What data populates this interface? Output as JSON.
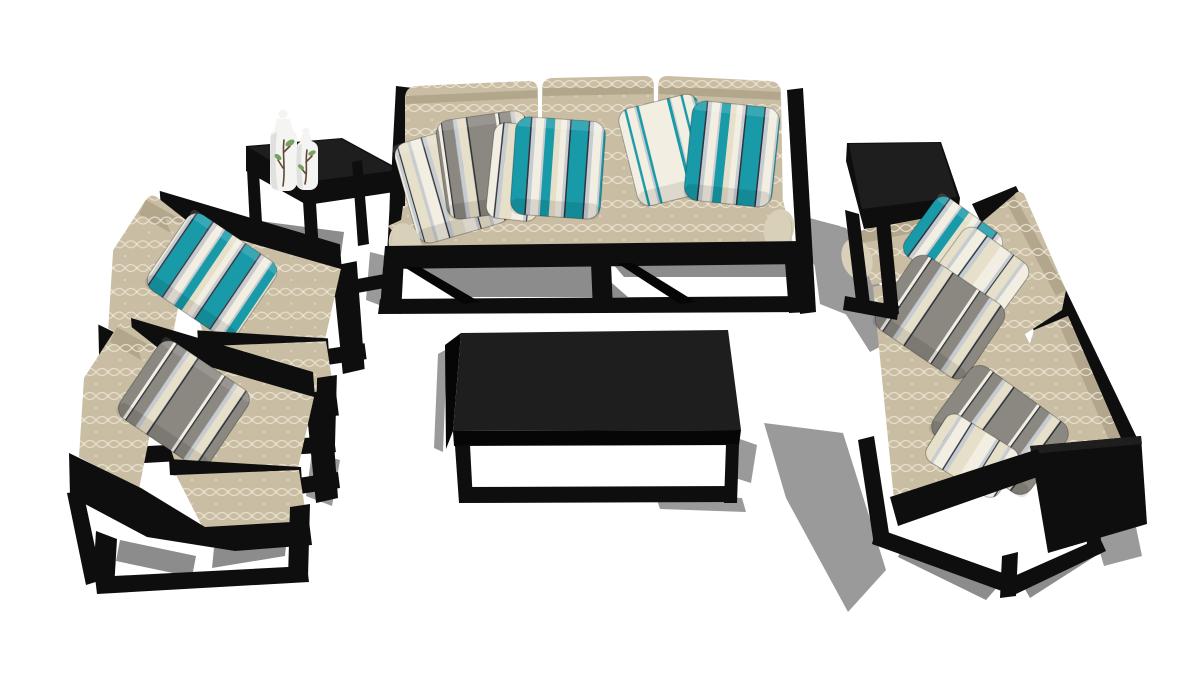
{
  "scene": {
    "subject": "3D render of a modern black metal-frame outdoor sofa set with beige patterned cushions and teal, gray and white striped throw pillows on a white floor",
    "style": "SketchUp-style three-quarter overhead product render",
    "background": "#ffffff"
  },
  "colors": {
    "frame-black": "#0e0e0e",
    "beige": "#c9bda3",
    "beige-dark": "#b2a78d",
    "beige-light": "#d9d0ba",
    "pattern-cream": "#ece5d2",
    "teal": "#189aa9",
    "pillow-white": "#f2eee2",
    "pillow-cream": "#e6dfc9",
    "silver": "#c6ccd2",
    "pillow-gray": "#8b8781",
    "stripe-dark": "#2f333c",
    "shadow": "#9a9a9a",
    "shadow-dark": "#8c8c8c",
    "shadow-light": "#c0c0c0",
    "vase-white": "#f4f4f2",
    "leaf-green": "#76a261",
    "branch-brown": "#5f4a33"
  },
  "objects": [
    {
      "id": "sofa-3-seat",
      "label": "Three-seat sofa",
      "frame": "black metal cube frame",
      "upholstery": "beige quatrefoil trellis fabric",
      "position": "top center",
      "pillows": [
        "white-stripe",
        "gray-stripe",
        "white-stripe",
        "teal-stripe",
        "white-teal-stripe",
        "teal-stripe"
      ]
    },
    {
      "id": "loveseat",
      "label": "Two-seat sofa",
      "frame": "black metal cube frame",
      "upholstery": "beige quatrefoil trellis fabric",
      "position": "right, angled toward center",
      "pillows": [
        "teal-stripe",
        "white-stripe",
        "gray-stripe",
        "gray-stripe",
        "cream-stripe"
      ]
    },
    {
      "id": "armchair-rear",
      "label": "Armchair",
      "position": "left, rear",
      "pillows": [
        "teal-stripe"
      ]
    },
    {
      "id": "armchair-front",
      "label": "Armchair",
      "position": "left, front",
      "pillows": [
        "gray-white-stripe"
      ]
    },
    {
      "id": "coffee-table",
      "label": "Rectangular coffee table",
      "material": "black metal",
      "position": "center"
    },
    {
      "id": "end-table-left",
      "label": "Square end table",
      "position": "between rear armchair and sofa",
      "decor": "two white ceramic bottle vases with painted leaf branches"
    },
    {
      "id": "end-table-right",
      "label": "Square end table",
      "position": "between sofa and loveseat",
      "decor": "none"
    }
  ],
  "lighting": {
    "floor": "seamless white",
    "shadows": "hard gray cast shadows toward lower-left and lower-right"
  }
}
